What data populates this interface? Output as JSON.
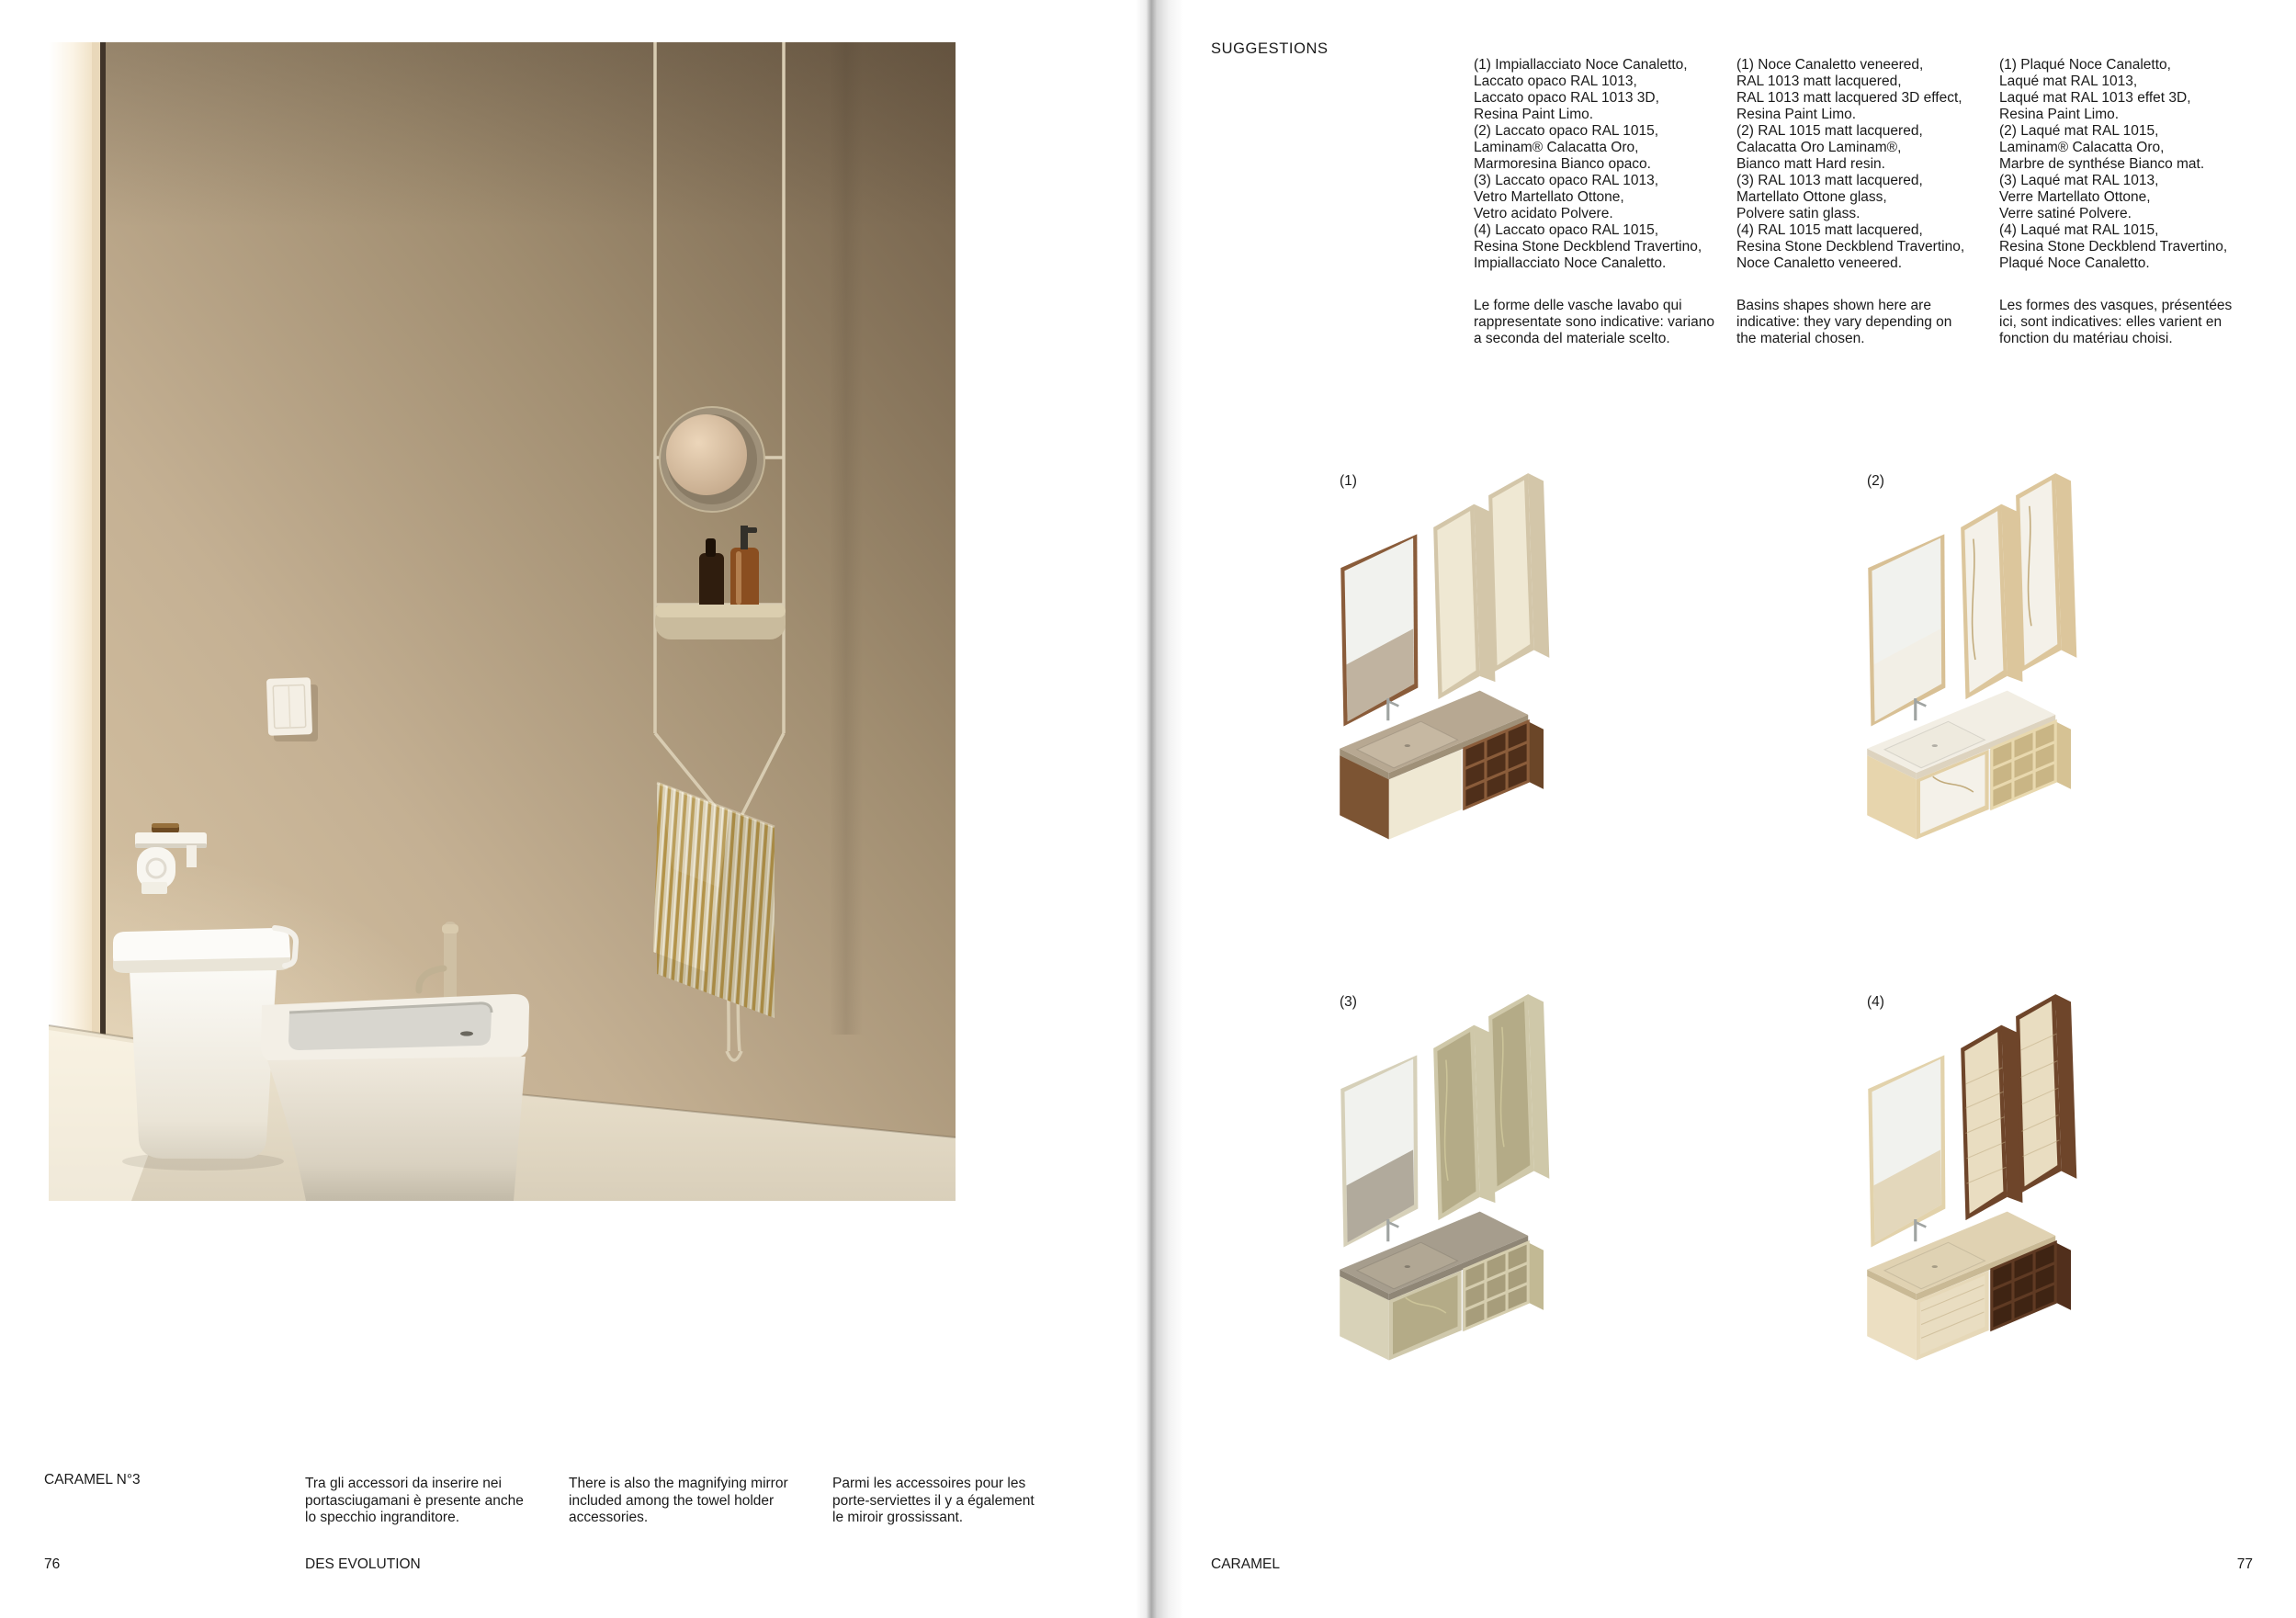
{
  "page_left": {
    "project_label": "CARAMEL N°3",
    "captions": {
      "it": "Tra gli accessori da inserire nei\nportasciugamani è presente anche\nlo specchio ingranditore.",
      "en": "There is also the magnifying mirror\nincluded among the towel holder\naccessories.",
      "fr": "Parmi les accessoires pour les\nporte-serviettes il y a également\nle miroir grossissant."
    },
    "footer_title": "DES EVOLUTION",
    "page_number": "76",
    "photo": {
      "subject": "bathroom with caramel plaster wall, white back-to-wall toilet and bidet, hanging towel rail with magnifying mirror, shelf with amber bottles and striped towel",
      "colors": {
        "wall_light": "#dcc9a9",
        "wall_dark": "#6f5d47",
        "floor": "#ece3cf",
        "ceramic_white": "#fbfaf6",
        "rail_champagne": "#d8ccb2",
        "towel_gold": "#b3934a",
        "towel_cream": "#d8cdb0",
        "bottle_amber": "#8a4e20",
        "bottle_dark": "#2f1d0e"
      }
    }
  },
  "page_right": {
    "header": "SUGGESTIONS",
    "columns": [
      {
        "lang": "it",
        "finishes": "(1) Impiallacciato Noce Canaletto,\nLaccato opaco RAL 1013,\nLaccato opaco RAL 1013 3D,\nResina Paint Limo.\n(2) Laccato opaco RAL 1015,\nLaminam® Calacatta Oro,\nMarmoresina Bianco opaco.\n(3) Laccato opaco RAL 1013,\nVetro Martellato Ottone,\nVetro acidato Polvere.\n(4) Laccato opaco RAL 1015,\nResina Stone Deckblend Travertino,\nImpiallacciato Noce Canaletto.",
        "note": "Le forme delle vasche lavabo qui\nrappresentate sono indicative: variano\na seconda del materiale scelto."
      },
      {
        "lang": "en",
        "finishes": "(1) Noce Canaletto veneered,\nRAL 1013 matt lacquered,\nRAL 1013 matt lacquered 3D effect,\nResina Paint Limo.\n(2) RAL 1015 matt lacquered,\nCalacatta Oro Laminam®,\nBianco matt Hard resin.\n(3) RAL 1013 matt lacquered,\nMartellato Ottone glass,\nPolvere satin glass.\n(4) RAL 1015 matt lacquered,\nResina Stone Deckblend Travertino,\nNoce Canaletto veneered.",
        "note": "Basins shapes shown here are\nindicative: they vary depending on\nthe material chosen."
      },
      {
        "lang": "fr",
        "finishes": "(1) Plaqué Noce Canaletto,\nLaqué mat RAL 1013,\nLaqué mat RAL 1013 effet 3D,\nResina Paint Limo.\n(2) Laqué mat RAL 1015,\nLaminam® Calacatta Oro,\nMarbre de synthése Bianco mat.\n(3) Laqué mat RAL 1013,\nVerre Martellato Ottone,\nVerre satiné Polvere.\n(4) Laqué mat RAL 1015,\nResina Stone Deckblend Travertino,\nPlaqué Noce Canaletto.",
        "note": "Les formes des vasques, présentées\nici, sont indicatives: elles varient en\nfonction du matériau choisi."
      }
    ],
    "renders": [
      {
        "label": "(1)",
        "finish": "Noce Canaletto veneer with cream matt lacquer",
        "colors": {
          "frame": "#8a5c3a",
          "cabtop": "#e7ddc4",
          "cabside": "#d3c6a9",
          "cabfront": "#efe8d3",
          "counter": "#b7a892",
          "counteredge": "#9f9078",
          "basin": "#c6b8a2",
          "bodyside": "#7c5433",
          "bodyframe": "#efe8d3",
          "bodyfront": "#efe8d3",
          "shelf": "#8a5c3a",
          "shelfdark": "#4f2f1a",
          "shelfside": "#6b4628",
          "vein": "transparent",
          "stria": "transparent"
        }
      },
      {
        "label": "(2)",
        "finish": "RAL 1015 matt lacquer with Calacatta Oro Laminam",
        "colors": {
          "frame": "#d8c095",
          "cabtop": "#e6d6ae",
          "cabside": "#dcc69c",
          "cabfront": "#f4f1e9",
          "counter": "#f2eee4",
          "counteredge": "#ddd3bf",
          "basin": "#eeeade",
          "bodyside": "#e7d5ad",
          "bodyframe": "#e2cfa5",
          "bodyfront": "#f4f1e9",
          "shelf": "#e8d8ae",
          "shelfdark": "#c9b585",
          "shelfside": "#d6c294",
          "vein": "#b59a60",
          "stria": "transparent"
        }
      },
      {
        "label": "(3)",
        "finish": "RAL 1013 matt lacquer with Martellato Ottone glass",
        "colors": {
          "frame": "#d6d0b9",
          "cabtop": "#d8d2b6",
          "cabside": "#cfc8a9",
          "cabfront": "#b4ab87",
          "counter": "#a69d8d",
          "counteredge": "#8f8676",
          "basin": "#b1a794",
          "bodyside": "#d8d2b8",
          "bodyframe": "#cfc8ab",
          "bodyfront": "#b4ab87",
          "shelf": "#d5cdae",
          "shelfdark": "#a79d7b",
          "shelfside": "#c2b994",
          "vein": "#d2ca9e",
          "stria": "transparent"
        }
      },
      {
        "label": "(4)",
        "finish": "Noce Canaletto with Resina Stone Deckblend Travertino",
        "colors": {
          "frame": "#e2d2ab",
          "cabtop": "#7a4e2e",
          "cabside": "#6e452a",
          "cabfront": "#e9ddc1",
          "counter": "#e0d2b2",
          "counteredge": "#c9b995",
          "basin": "#dfd2b3",
          "bodyside": "#ecdfc2",
          "bodyframe": "#e6d8b8",
          "bodyfront": "#e9ddc1",
          "shelf": "#5f3a23",
          "shelfdark": "#3f2413",
          "shelfside": "#512f1c",
          "vein": "transparent",
          "stria": "#c0ab84"
        }
      }
    ],
    "footer_title": "CARAMEL",
    "page_number": "77"
  }
}
